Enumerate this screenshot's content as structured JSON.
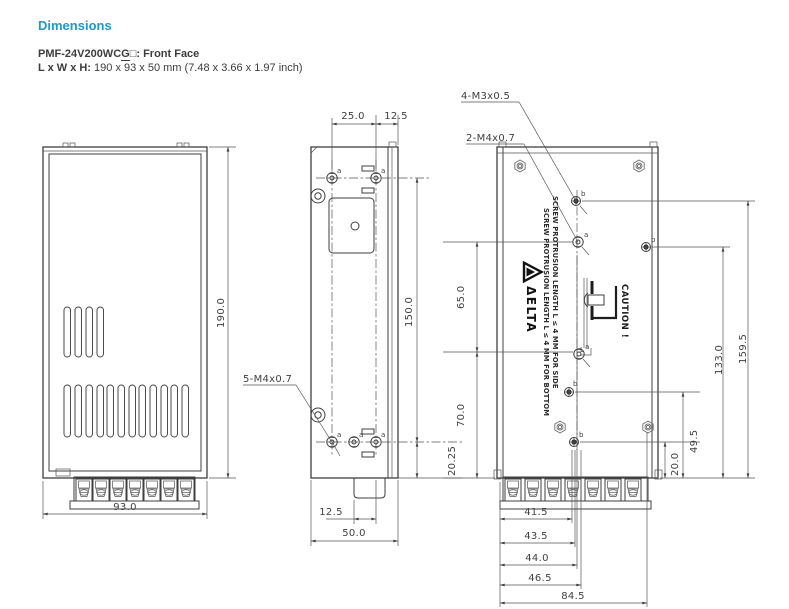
{
  "header": {
    "section_title": "Dimensions",
    "model_part1": "PMF-24V200WC",
    "model_g": "G",
    "model_part2": "□: Front Face",
    "size_label": "L x W x H:",
    "size_value": " 190 x 93 x 50 mm (7.48 x 3.66 x 1.97 inch)"
  },
  "markers": {
    "a": "a",
    "b": "b"
  },
  "front_view": {
    "height": "190.0",
    "width": "93.0"
  },
  "side_view": {
    "hole_callout": "5-M4x0.7",
    "dim_top_span": "25.0",
    "dim_top_edge": "12.5",
    "dim_height": "150.0",
    "dim_bottom_offset": "20.25",
    "dim_bottom_holes": "12.5",
    "dim_width": "50.0"
  },
  "back_view": {
    "callout_m3": "4-M3x0.5",
    "callout_m4": "2-M4x0.7",
    "dim_left_upper": "65.0",
    "dim_left_lower": "70.0",
    "dim_right_outer": "159.5",
    "dim_right_inner": "133.0",
    "dim_right_lower": "49.5",
    "dim_right_bottom": "20.0",
    "bottom_dims": [
      "41.5",
      "43.5",
      "44.0",
      "46.5",
      "84.5"
    ],
    "note_side": "SCREW PROTRUSION LENGTH  L ≤ 4 MM FOR SIDE",
    "note_bottom": "SCREW PROTRUSION LENGTH  L ≤ 4 MM FOR BOTTOM",
    "caution": "CAUTION !",
    "caution_l": "L",
    "brand": "ΔELTA"
  }
}
